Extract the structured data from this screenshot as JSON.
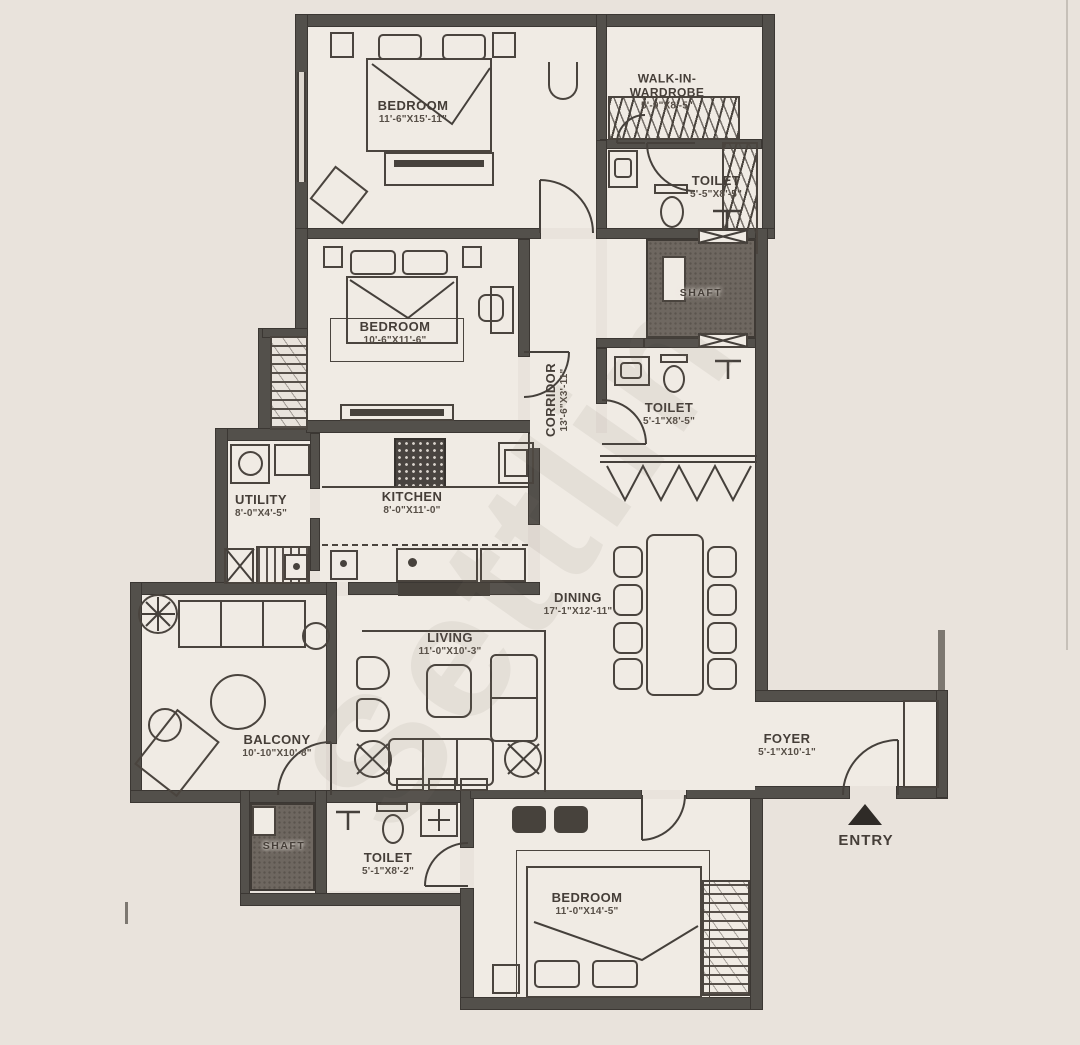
{
  "watermark": "Settlin",
  "entry": {
    "label": "ENTRY"
  },
  "rooms": {
    "bedroom1": {
      "name": "BEDROOM",
      "dims": "11'-6\"X15'-11\""
    },
    "walk_in_wardrobe": {
      "name": "WALK-IN-\nWARDROBE",
      "dims": "5'-9\"X8'-5\""
    },
    "toilet1": {
      "name": "TOILET",
      "dims": "5'-5\"X8'-5\""
    },
    "shaft1": {
      "name": "SHAFT"
    },
    "bedroom2": {
      "name": "BEDROOM",
      "dims": "10'-6\"X11'-6\""
    },
    "corridor": {
      "name": "CORRIDOR",
      "dims": "13'-6\"X3'-11\""
    },
    "toilet2": {
      "name": "TOILET",
      "dims": "5'-1\"X8'-5\""
    },
    "utility": {
      "name": "UTILITY",
      "dims": "8'-0\"X4'-5\""
    },
    "kitchen": {
      "name": "KITCHEN",
      "dims": "8'-0\"X11'-0\""
    },
    "dining": {
      "name": "DINING",
      "dims": "17'-1\"X12'-11\""
    },
    "living": {
      "name": "LIVING",
      "dims": "11'-0\"X10'-3\""
    },
    "balcony": {
      "name": "BALCONY",
      "dims": "10'-10\"X10'-8\""
    },
    "foyer": {
      "name": "FOYER",
      "dims": "5'-1\"X10'-1\""
    },
    "toilet3": {
      "name": "TOILET",
      "dims": "5'-1\"X8'-2\""
    },
    "shaft2": {
      "name": "SHAFT"
    },
    "bedroom3": {
      "name": "BEDROOM",
      "dims": "11'-0\"X14'-5\""
    }
  },
  "colors": {
    "background": "#e9e3dc",
    "room_fill": "#f0ebe4",
    "wall": "#53504b",
    "line": "#4a443e",
    "text": "#453e38"
  }
}
